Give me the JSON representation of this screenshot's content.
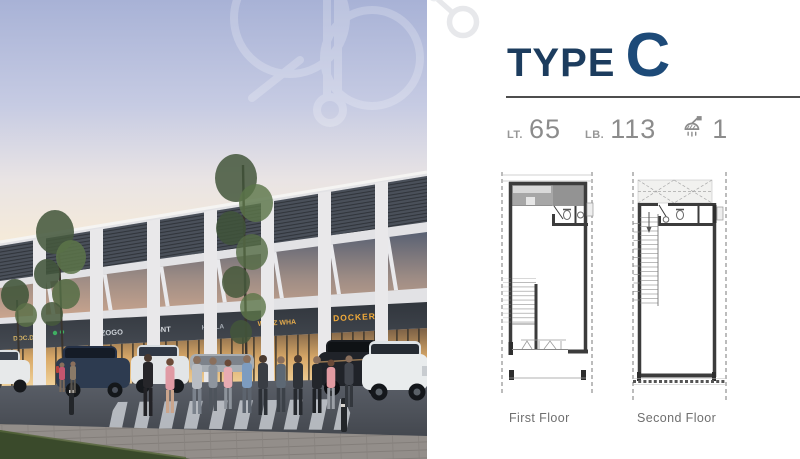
{
  "colors": {
    "navy": "#1c3c5e",
    "title_letter": "#1d4a78",
    "divider": "#4d4d4d",
    "spec": "#8c8c8c",
    "plan_label": "#6f6f6f",
    "plan_line": "#3c3c3c",
    "sign_band": "#383d44"
  },
  "panel": {
    "title_prefix": "TYPE",
    "title_letter": "C",
    "specs": [
      {
        "label": "LT.",
        "value": "65"
      },
      {
        "label": "LB.",
        "value": "113"
      },
      {
        "icon": "shower-icon",
        "value": "1"
      }
    ],
    "plans": [
      {
        "label": "First Floor"
      },
      {
        "label": "Second Floor"
      }
    ]
  },
  "photo": {
    "signs": [
      {
        "text": "DOC.DR",
        "color": "#d9b666"
      },
      {
        "text": "ZOGO",
        "color": "#ccd1d7"
      },
      {
        "text": "GNT",
        "color": "#d4d8dd"
      },
      {
        "text": "HOLLA",
        "color": "#a8aeb6"
      },
      {
        "text": "WALZ WHA",
        "color": "#e3aa4c"
      },
      {
        "text": "DOCKERS",
        "color": "#f2ab3a"
      }
    ]
  }
}
